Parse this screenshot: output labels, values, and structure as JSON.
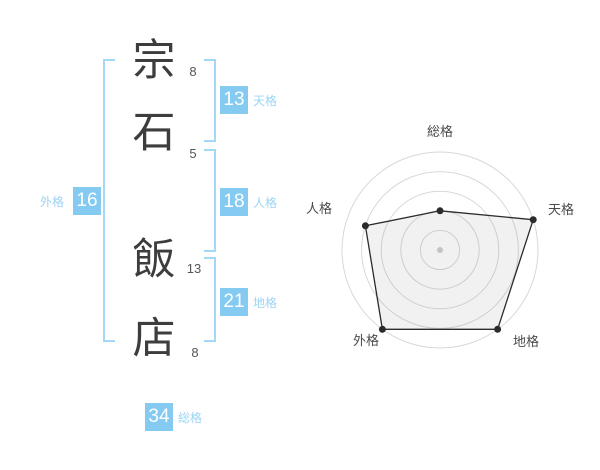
{
  "name_analysis": {
    "full_name": "宗石飯店",
    "chars": [
      {
        "char": "宗",
        "strokes": "8"
      },
      {
        "char": "石",
        "strokes": "5"
      },
      {
        "char": "飯",
        "strokes": "13"
      },
      {
        "char": "店",
        "strokes": "8"
      }
    ],
    "values": {
      "tenkaku": {
        "label": "天格",
        "value": "13"
      },
      "jinkaku": {
        "label": "人格",
        "value": "18"
      },
      "chikaku": {
        "label": "地格",
        "value": "21"
      },
      "gaikaku": {
        "label": "外格",
        "value": "16"
      },
      "soukaku": {
        "label": "総格",
        "value": "34"
      }
    }
  },
  "chart_data": {
    "type": "radar",
    "axes": [
      "総格",
      "天格",
      "地格",
      "外格",
      "人格"
    ],
    "values": [
      2,
      5,
      5,
      5,
      4
    ],
    "max": 5,
    "rings": 5,
    "legend": "none",
    "grid": "circular",
    "colors": {
      "grid": "#d8d8d8",
      "polygon_fill": "rgba(120,120,120,0.10)",
      "polygon_stroke": "#2b2b2b",
      "vertex": "#2b2b2b",
      "center_dot": "#c4c4c4",
      "label": "#4a4a4a"
    }
  },
  "colors": {
    "badge_bg": "#84caf1",
    "badge_text": "#ffffff",
    "badge_label": "#9bd4f4",
    "bracket": "#a3d9f7",
    "kanji": "#3d3d3d",
    "stroke_count": "#555555"
  }
}
